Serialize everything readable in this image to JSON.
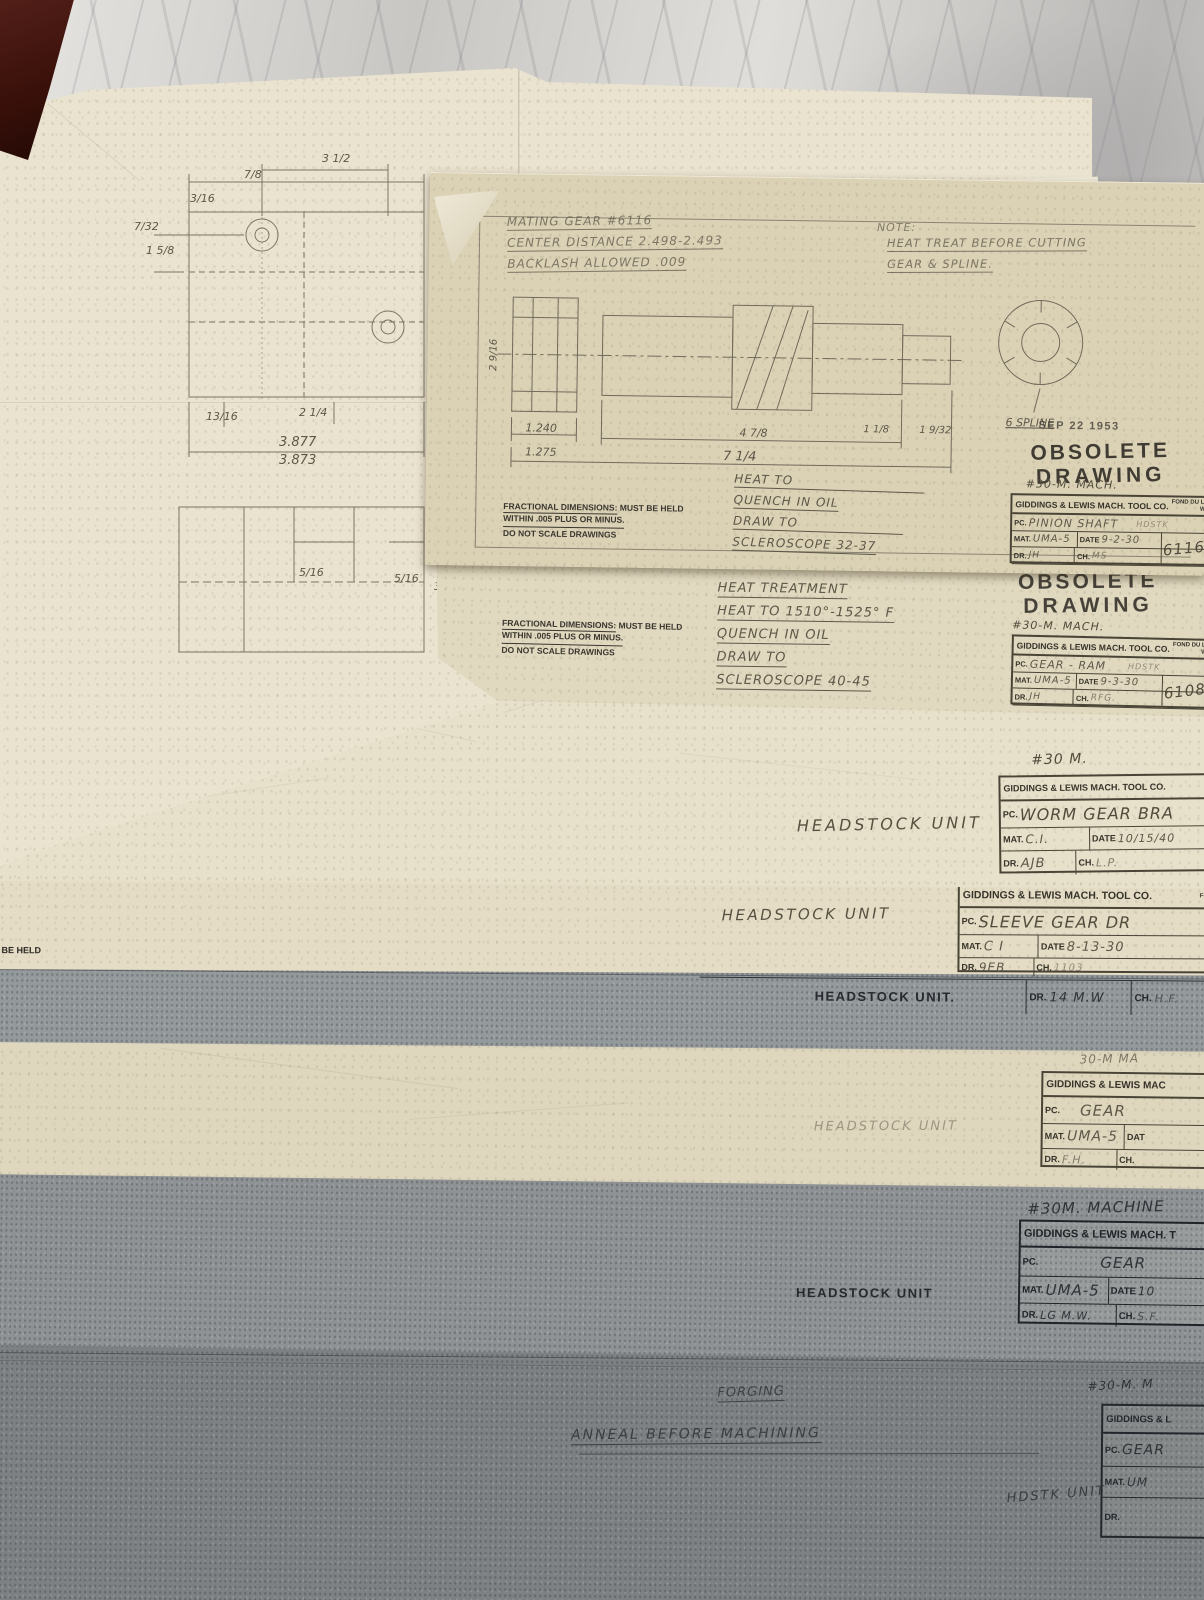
{
  "colors": {
    "marble": "#d2d0cd",
    "cream": "#e6dec7",
    "tan": "#d8cfb2",
    "gray_sheet": "#92979a",
    "dark_gray_sheet": "#7d8183",
    "graphite": "#5d5748",
    "ink": "#2f3237",
    "stamp": "#454039"
  },
  "tb_labels": {
    "pc": "PC.",
    "mat": "MAT.",
    "date": "DATE",
    "dr": "DR.",
    "ch": "CH."
  },
  "pencil_sheet": {
    "dims": {
      "t1": "3/16",
      "t2": "7/8",
      "t3": "3 1/2",
      "t4": "3/8",
      "l1": "7/32",
      "l2": "1 5/8",
      "m1": "13/16",
      "m2": "2 1/4",
      "fit_top": "3.877",
      "fit_bot": "3.873",
      "b1": "5/16",
      "b2": "5/16",
      "b3": "3/8"
    }
  },
  "pinion_sheet": {
    "notes_left": [
      "MATING GEAR #6116",
      "CENTER DISTANCE 2.498-2.493",
      "BACKLASH ALLOWED .009"
    ],
    "note_right": [
      "NOTE:",
      "HEAT TREAT BEFORE CUTTING",
      "GEAR & SPLINE."
    ],
    "date_stamp": "SEP 22 1953",
    "obsolete": [
      "OBSOLETE",
      "DRAWING"
    ],
    "machine_note": "#30-M. MACH.",
    "dims": {
      "len1a": "1.240",
      "len1b": "1.275",
      "len2": "4 7/8",
      "len3": "7 1/4",
      "sm1": "1 1/8",
      "sm2": "1 9/32",
      "vert": "2 9/16",
      "spline": "6 SPLINE"
    },
    "heat_notes": [
      "HEAT TO",
      "QUENCH IN OIL",
      "DRAW TO",
      "SCLEROSCOPE 32-37"
    ],
    "fractional": {
      "u1": "FRACTIONAL DIMENSIONS:",
      "r1": "MUST BE HELD",
      "l2": "WITHIN .005 PLUS OR MINUS.",
      "l3": "DO NOT SCALE DRAWINGS"
    },
    "title_block": {
      "company": "GIDDINGS & LEWIS MACH. TOOL CO.",
      "loc1": "FOND DU LAC",
      "loc2": "WIS.",
      "pc": "PINION SHAFT",
      "pc_note": "HDSTK",
      "mat": "UMA-5",
      "date": "9-2-30",
      "dr": "JH",
      "ch": "MS",
      "number": "6116"
    }
  },
  "gear_ram_sheet": {
    "date_stamp": "SEP 22 1953",
    "obsolete": [
      "OBSOLETE",
      "DRAWING"
    ],
    "heat_notes": [
      "HEAT TREATMENT",
      "HEAT TO 1510°-1525° F",
      "QUENCH IN OIL",
      "DRAW TO",
      "SCLEROSCOPE 40-45"
    ],
    "machine_note": "#30-M. MACH.",
    "fractional": {
      "u1": "FRACTIONAL DIMENSIONS:",
      "r1": "MUST BE HELD",
      "l2": "WITHIN .005 PLUS OR MINUS.",
      "l3": "DO NOT SCALE DRAWINGS"
    },
    "title_block": {
      "company": "GIDDINGS & LEWIS MACH. TOOL CO.",
      "loc1": "FOND DU LAC",
      "loc2": "WIS.",
      "pc": "GEAR - RAM",
      "pc_note": "HDSTK",
      "mat": "UMA-5",
      "date": "9-3-30",
      "dr": "JH",
      "ch": "RFG.",
      "number": "6108"
    }
  },
  "worm_gear_sheet": {
    "chamfer_note": "16 X 45 CHAMFER",
    "edge_note": "BE HELD",
    "headstock": "HEADSTOCK UNIT",
    "machine_note": "#30 M.",
    "title_block": {
      "company": "GIDDINGS & LEWIS MACH. TOOL CO.",
      "pc": "WORM GEAR BRA",
      "mat": "C.I.",
      "date": "10/15/40",
      "dr": "AJB",
      "ch": "L.P."
    }
  },
  "sleeve_gear_sheet": {
    "edge_note": "T BE HELD",
    "headstock": "HEADSTOCK UNIT",
    "title_block": {
      "company": "GIDDINGS & LEWIS MACH. TOOL CO.",
      "loc1": "FOND",
      "pc": "SLEEVE GEAR DR",
      "mat": "C I",
      "date": "8-13-30",
      "dr": "9EB",
      "ch": "1103"
    }
  },
  "gray_strip_sheet": {
    "headstock": "HEADSTOCK UNIT.",
    "dr": "14 M.W",
    "ch": "H.F."
  },
  "gear_uma_sheet": {
    "machine_note": "30-M MA",
    "headstock": "HEADSTOCK UNIT",
    "title_block": {
      "company": "GIDDINGS & LEWIS MAC",
      "date_label": "DAT",
      "pc": "GEAR",
      "mat": "UMA-5",
      "dr": "F.H."
    }
  },
  "machine_sheet": {
    "machine_note": "#30M. MACHINE",
    "headstock": "HEADSTOCK UNIT",
    "title_block": {
      "company": "GIDDINGS & LEWIS MACH. T",
      "pc": "GEAR",
      "mat": "UMA-5",
      "date": "10",
      "dr": "LG M.W.",
      "ch": "S.F."
    }
  },
  "forging_sheet": {
    "note_forging": "FORGING",
    "note_anneal": "ANNEAL BEFORE MACHINING",
    "machine_note": "#30-M. M",
    "headstock": "HDSTK UNIT",
    "title_block": {
      "company": "GIDDINGS & L",
      "pc": "GEAR",
      "mat": "UM"
    }
  }
}
